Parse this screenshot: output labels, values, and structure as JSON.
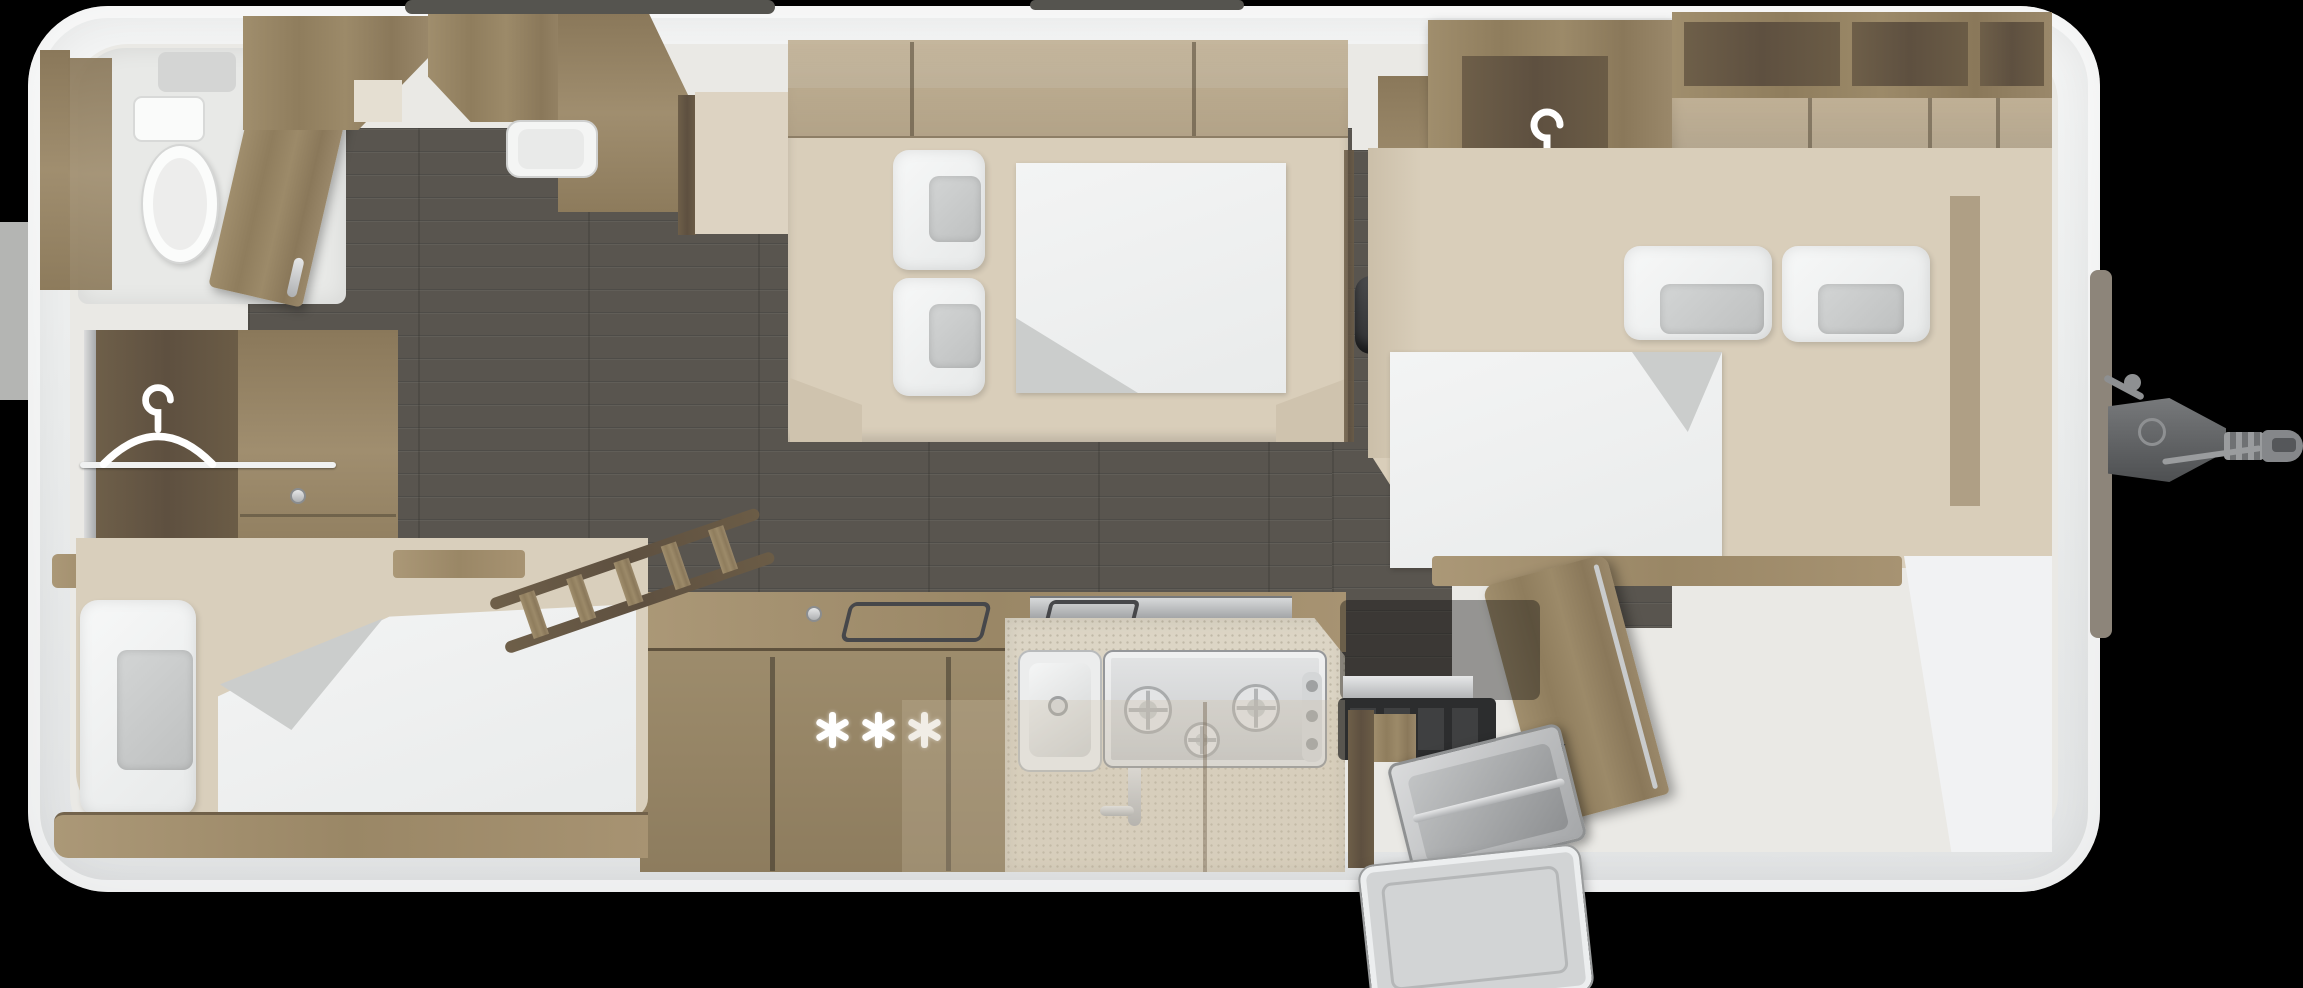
{
  "scene": {
    "title": "Caravan interior floor plan, top-down 3D render",
    "background_color": "#000000",
    "body_color": "#f3f4f4",
    "floor_color": "#59554f",
    "wood_color": "#978564",
    "dark_wood_color": "#65573f",
    "mattress_color": "#d9ceba",
    "linen_color": "#f1f2f2",
    "cushion_gray": "#c8cac9",
    "heater_color": "#2c2d2e"
  },
  "icons": {
    "hanger": "clothes-hanger-icon",
    "freezer_star": "six-spoke-asterisk-icon",
    "tow_hitch": "tow-hitch"
  },
  "zones": {
    "front_bathroom": {
      "name": "bathroom",
      "fixtures": [
        "toilet",
        "shower-tray",
        "cabinet",
        "open-door"
      ]
    },
    "central_bed": {
      "name": "front-transverse-bed",
      "pillow_count": 2,
      "duvet_count": 1
    },
    "left_wardrobe": {
      "name": "wardrobe-open",
      "icon": "clothes-hanger-icon"
    },
    "right_wardrobe": {
      "name": "wardrobe-open",
      "icon": "clothes-hanger-icon"
    },
    "rear_bed": {
      "name": "rear-double-bed",
      "pillow_count": 2,
      "duvet_count": 1
    },
    "side_bed": {
      "name": "side-single-bed",
      "pillow_count": 1,
      "duvet_count": 1
    },
    "kitchen": {
      "name": "kitchen-block",
      "sink_count": 1,
      "hob_burner_count": 3,
      "freezer_star_count": 3
    },
    "heater": {
      "name": "heater-unit"
    },
    "ladder": {
      "name": "bunk-ladder",
      "rung_count": 5
    },
    "rear_washroom": {
      "name": "corner-washbasin"
    },
    "entry_door": {
      "name": "entrance-door-open"
    },
    "tow_hitch": {
      "name": "tow-hitch"
    }
  }
}
